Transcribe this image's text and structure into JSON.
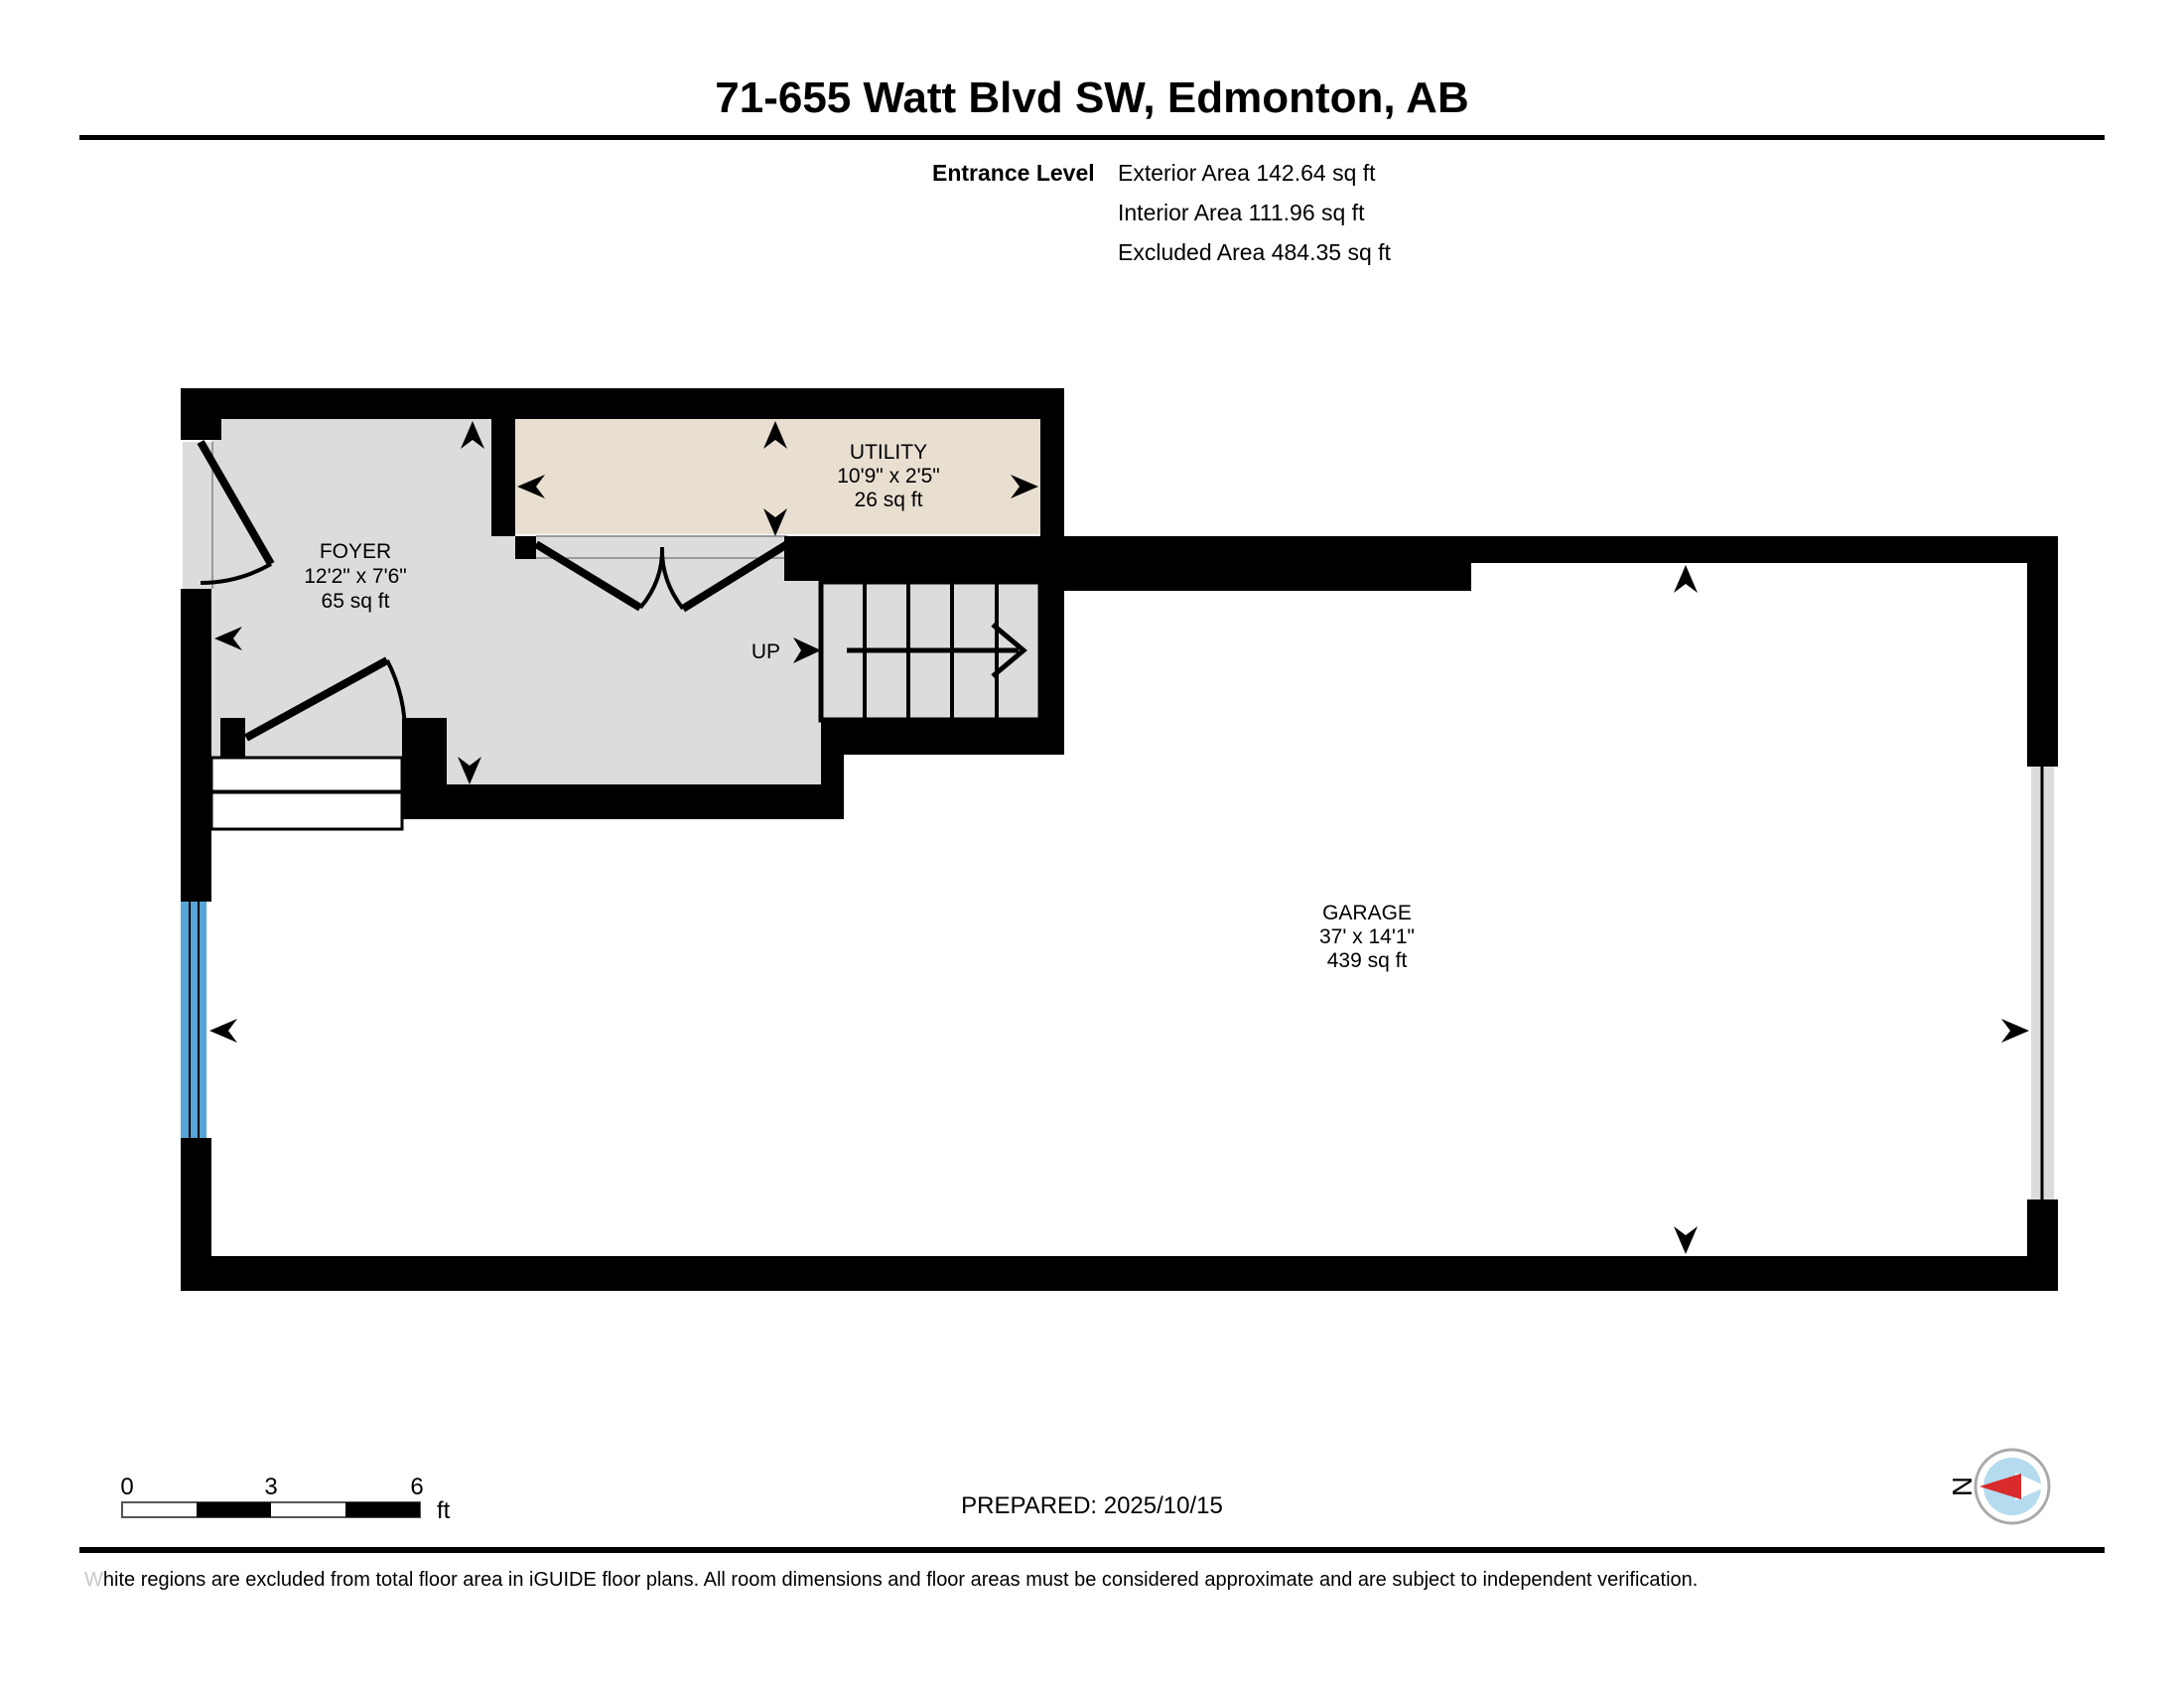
{
  "header": {
    "title": "71-655 Watt Blvd SW, Edmonton, AB",
    "level": "Entrance Level",
    "exterior": "Exterior Area 142.64 sq ft",
    "interior": "Interior Area 111.96 sq ft",
    "excluded": "Excluded Area 484.35 sq ft"
  },
  "rooms": {
    "foyer": {
      "name": "FOYER",
      "dims": "12'2\" x 7'6\"",
      "area": "65 sq ft"
    },
    "utility": {
      "name": "UTILITY",
      "dims": "10'9\" x 2'5\"",
      "area": "26 sq ft"
    },
    "garage": {
      "name": "GARAGE",
      "dims": "37' x 14'1\"",
      "area": "439 sq ft"
    }
  },
  "stairs": {
    "up_label": "UP"
  },
  "scale_bar": {
    "tick0": "0",
    "tick1": "3",
    "tick2": "6",
    "unit": "ft"
  },
  "footer": {
    "prepared": "PREPARED: 2025/10/15",
    "compass_north": "N",
    "disclaimer_lead": "W",
    "disclaimer_rest": "hite regions are excluded from total floor area in iGUIDE floor plans. All room dimensions and floor areas must be considered approximate and are subject to independent verification."
  },
  "colors": {
    "wall": "#000000",
    "interior_gray": "#dcdcdc",
    "utility_beige": "#e8dfd1",
    "garage_door_blue": "#57a5d6",
    "compass_blue": "#b5dbee",
    "compass_red": "#d92b2b",
    "opening_line": "#9a9a9a"
  }
}
